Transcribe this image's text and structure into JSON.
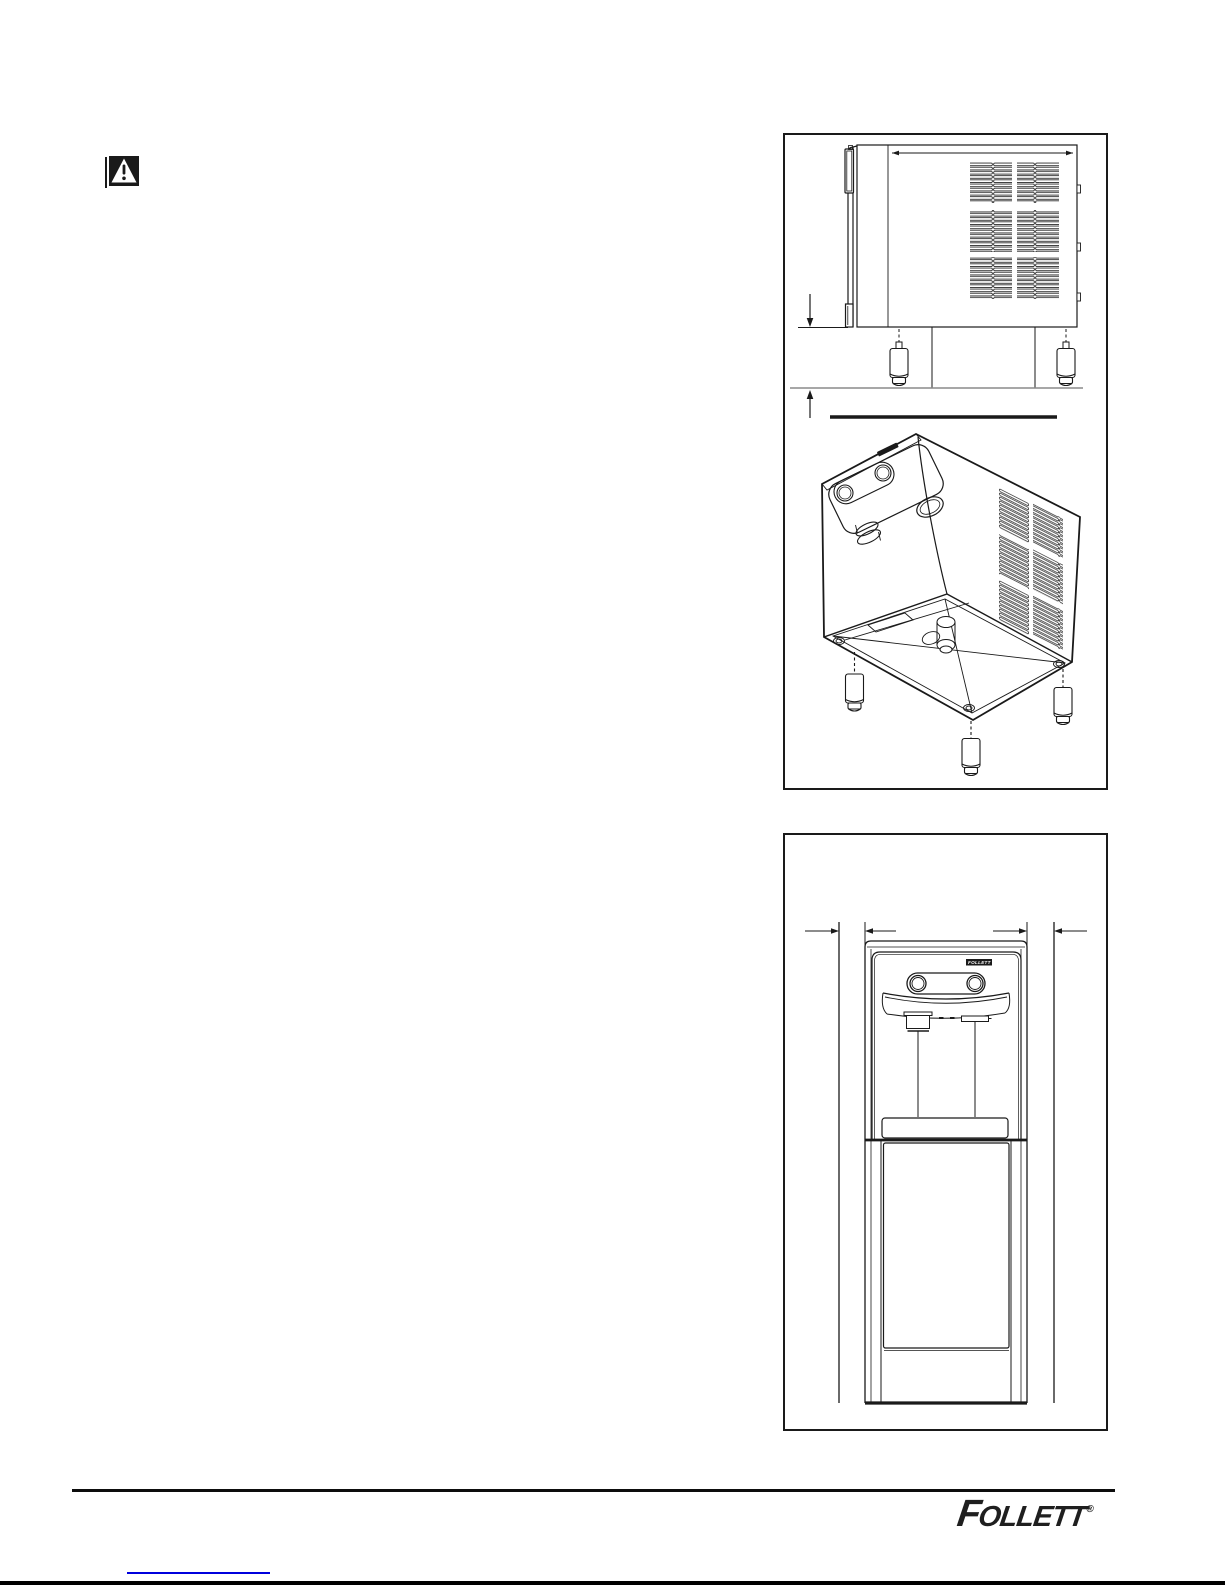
{
  "ink": "#1a1a1a",
  "warning": {
    "icon": "warning-triangle-icon"
  },
  "figure_bottom": {
    "badge_text": "FOLLETT"
  },
  "footer": {
    "brand": "FOLLETT",
    "registered_mark": "®",
    "link_color": "#0000dd"
  }
}
